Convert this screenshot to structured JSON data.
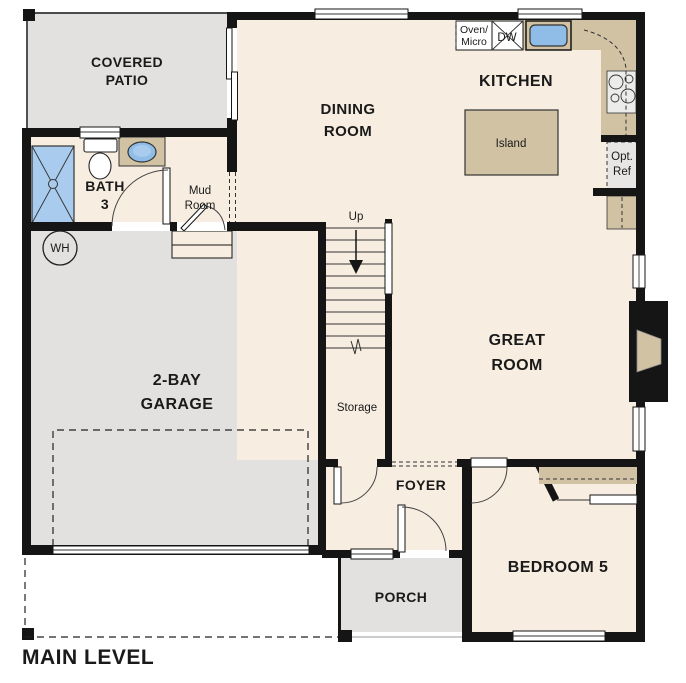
{
  "title": "MAIN LEVEL",
  "palette": {
    "wall_black": "#151515",
    "floor_cream": "#f7eee1",
    "outdoor_gray": "#e2e1df",
    "counter_tan": "#d1c2a4",
    "appliance_gray": "#ececea",
    "fixture_blue": "#a8cbee",
    "sink_blue": "#8fbde8",
    "text_black": "#1a1a1a"
  },
  "rooms": {
    "covered_patio": {
      "line1": "COVERED",
      "line2": "PATIO"
    },
    "dining_room": {
      "line1": "DINING",
      "line2": "ROOM"
    },
    "kitchen": {
      "label": "KITCHEN"
    },
    "great_room": {
      "line1": "GREAT",
      "line2": "ROOM"
    },
    "garage": {
      "line1": "2-BAY",
      "line2": "GARAGE"
    },
    "bath_3": {
      "line1": "BATH",
      "line2": "3"
    },
    "mud_room": {
      "line1": "Mud",
      "line2": "Room"
    },
    "storage": {
      "label": "Storage"
    },
    "foyer": {
      "label": "FOYER"
    },
    "porch": {
      "label": "PORCH"
    },
    "bedroom_5": {
      "label": "BEDROOM 5"
    }
  },
  "fixtures": {
    "water_heater": "WH",
    "oven_micro_line1": "Oven/",
    "oven_micro_line2": "Micro",
    "dishwasher": "DW",
    "island": "Island",
    "opt_ref_line1": "Opt.",
    "opt_ref_line2": "Ref",
    "stairs_direction": "Up"
  }
}
